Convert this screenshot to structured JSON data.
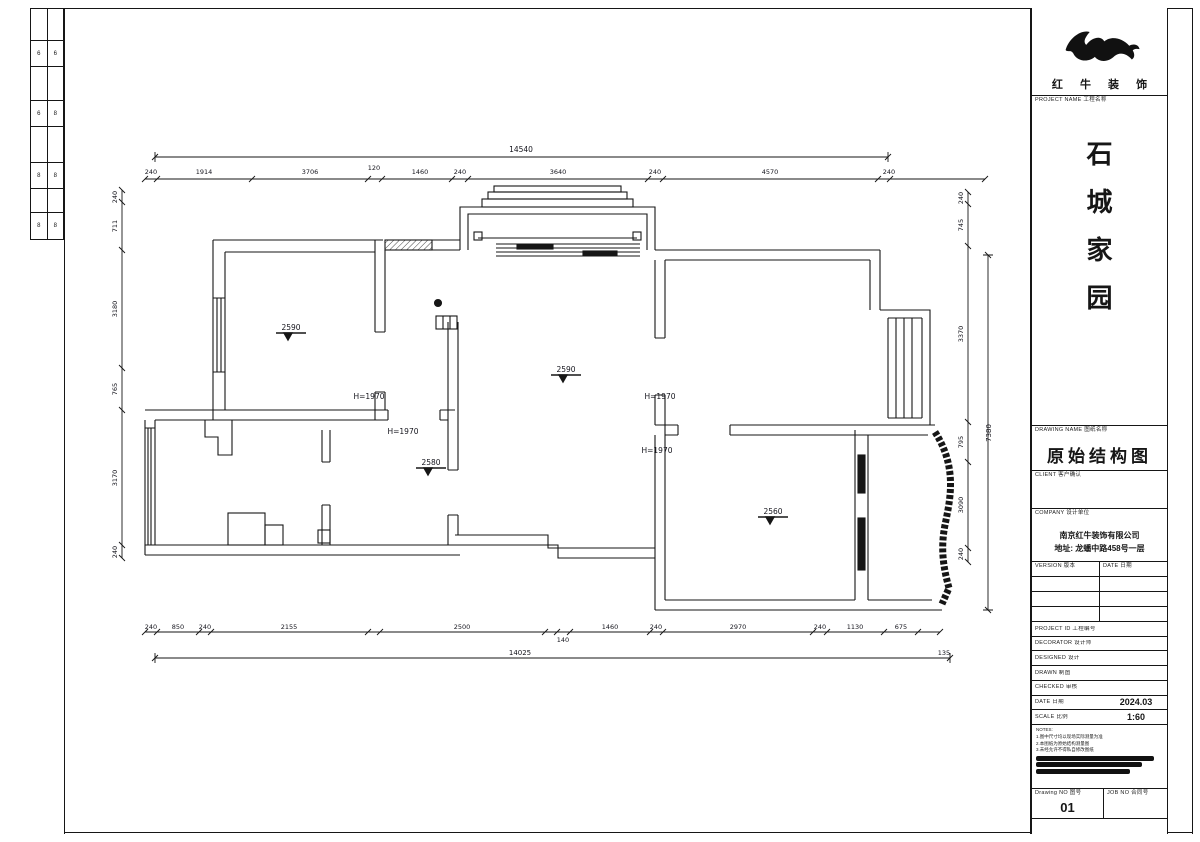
{
  "page": {
    "bg": "#ffffff",
    "line_color": "#161616"
  },
  "binding_strip": {
    "cells": [
      {
        "l": "6",
        "r": "6"
      },
      {
        "l": "6",
        "r": "8"
      },
      {
        "l": "8",
        "r": "8"
      },
      {
        "l": "8",
        "r": "8"
      }
    ]
  },
  "title_block": {
    "brand_name": "红 牛 装 饰",
    "labels": {
      "project_name": "PROJECT NAME  工程名称",
      "drawing_name": "DRAWING NAME  图纸名称",
      "client": "CLIENT  客户确认",
      "company": "COMPANY  设计单位",
      "version": "VERSION  版本",
      "version_date": "DATE  日期",
      "project_id": "PROJECT ID  工程编号",
      "decorator": "DECORATOR  设计师",
      "designed": "DESIGNED  设计",
      "drawn": "DRAWN  制图",
      "checked": "CHECKED  审核",
      "date": "DATE  日期",
      "scale": "SCALE  比例",
      "drawing_no": "Drawing NO  图号",
      "job_no": "JOB NO  合同号"
    },
    "project_name_chars": [
      "石",
      "城",
      "家",
      "园"
    ],
    "drawing_name_value": "原始结构图",
    "company_line1": "南京红牛装饰有限公司",
    "company_line2": "地址: 龙蟠中路458号一层",
    "date_value": "2024.03",
    "scale_value": "1:60",
    "drawing_no_value": "01",
    "notes": [
      "NOTES:",
      "1.图中尺寸均以现场实际测量为准",
      "2.本图纸为原始结构测量图",
      "3.未经允许不得私自修改图纸"
    ]
  },
  "plan": {
    "labels": [
      {
        "t": "14540",
        "x": 521,
        "y": 152,
        "s": 7.5,
        "n": "dim-top-overall"
      },
      {
        "t": "240",
        "x": 151,
        "y": 174
      },
      {
        "t": "1914",
        "x": 204,
        "y": 174
      },
      {
        "t": "3706",
        "x": 310,
        "y": 174
      },
      {
        "t": "120",
        "x": 374,
        "y": 170
      },
      {
        "t": "1460",
        "x": 420,
        "y": 174
      },
      {
        "t": "240",
        "x": 460,
        "y": 174
      },
      {
        "t": "3640",
        "x": 558,
        "y": 174
      },
      {
        "t": "240",
        "x": 655,
        "y": 174
      },
      {
        "t": "4570",
        "x": 770,
        "y": 174
      },
      {
        "t": "240",
        "x": 889,
        "y": 174
      },
      {
        "t": "240",
        "x": 117,
        "y": 197,
        "r": -90
      },
      {
        "t": "711",
        "x": 117,
        "y": 226,
        "r": -90
      },
      {
        "t": "3180",
        "x": 117,
        "y": 309,
        "r": -90
      },
      {
        "t": "765",
        "x": 117,
        "y": 389,
        "r": -90
      },
      {
        "t": "3170",
        "x": 117,
        "y": 478,
        "r": -90
      },
      {
        "t": "240",
        "x": 117,
        "y": 552,
        "r": -90
      },
      {
        "t": "240",
        "x": 963,
        "y": 198,
        "r": -90
      },
      {
        "t": "745",
        "x": 963,
        "y": 225,
        "r": -90
      },
      {
        "t": "3370",
        "x": 963,
        "y": 334,
        "r": -90
      },
      {
        "t": "795",
        "x": 963,
        "y": 442,
        "r": -90
      },
      {
        "t": "3090",
        "x": 963,
        "y": 505,
        "r": -90
      },
      {
        "t": "240",
        "x": 963,
        "y": 554,
        "r": -90
      },
      {
        "t": "7380",
        "x": 991,
        "y": 433,
        "r": -90,
        "s": 7,
        "n": "dim-right-overall"
      },
      {
        "t": "240",
        "x": 151,
        "y": 629
      },
      {
        "t": "850",
        "x": 178,
        "y": 629
      },
      {
        "t": "240",
        "x": 205,
        "y": 629
      },
      {
        "t": "2155",
        "x": 289,
        "y": 629
      },
      {
        "t": "2500",
        "x": 462,
        "y": 629
      },
      {
        "t": "140",
        "x": 563,
        "y": 642
      },
      {
        "t": "1460",
        "x": 610,
        "y": 629
      },
      {
        "t": "240",
        "x": 656,
        "y": 629
      },
      {
        "t": "2970",
        "x": 738,
        "y": 629
      },
      {
        "t": "240",
        "x": 820,
        "y": 629
      },
      {
        "t": "1130",
        "x": 855,
        "y": 629
      },
      {
        "t": "675",
        "x": 901,
        "y": 629
      },
      {
        "t": "14025",
        "x": 520,
        "y": 655,
        "s": 7,
        "n": "dim-bottom-overall"
      },
      {
        "t": "135",
        "x": 944,
        "y": 655
      },
      {
        "t": "H=1970",
        "x": 369,
        "y": 399,
        "s": 7.5,
        "n": "beam-height-label"
      },
      {
        "t": "H=1970",
        "x": 403,
        "y": 434,
        "s": 7.5,
        "n": "beam-height-label"
      },
      {
        "t": "H=1970",
        "x": 660,
        "y": 399,
        "s": 7.5,
        "n": "beam-height-label"
      },
      {
        "t": "H=1970",
        "x": 657,
        "y": 453,
        "s": 7.5,
        "n": "beam-height-label"
      },
      {
        "t": "2590",
        "x": 291,
        "y": 330,
        "s": 7.5,
        "n": "ceiling-height-label"
      },
      {
        "t": "2590",
        "x": 566,
        "y": 372,
        "s": 7.5,
        "n": "ceiling-height-label"
      },
      {
        "t": "2580",
        "x": 431,
        "y": 465,
        "s": 7.5,
        "n": "ceiling-height-label"
      },
      {
        "t": "2560",
        "x": 773,
        "y": 514,
        "s": 7.5,
        "n": "ceiling-height-label"
      }
    ]
  }
}
